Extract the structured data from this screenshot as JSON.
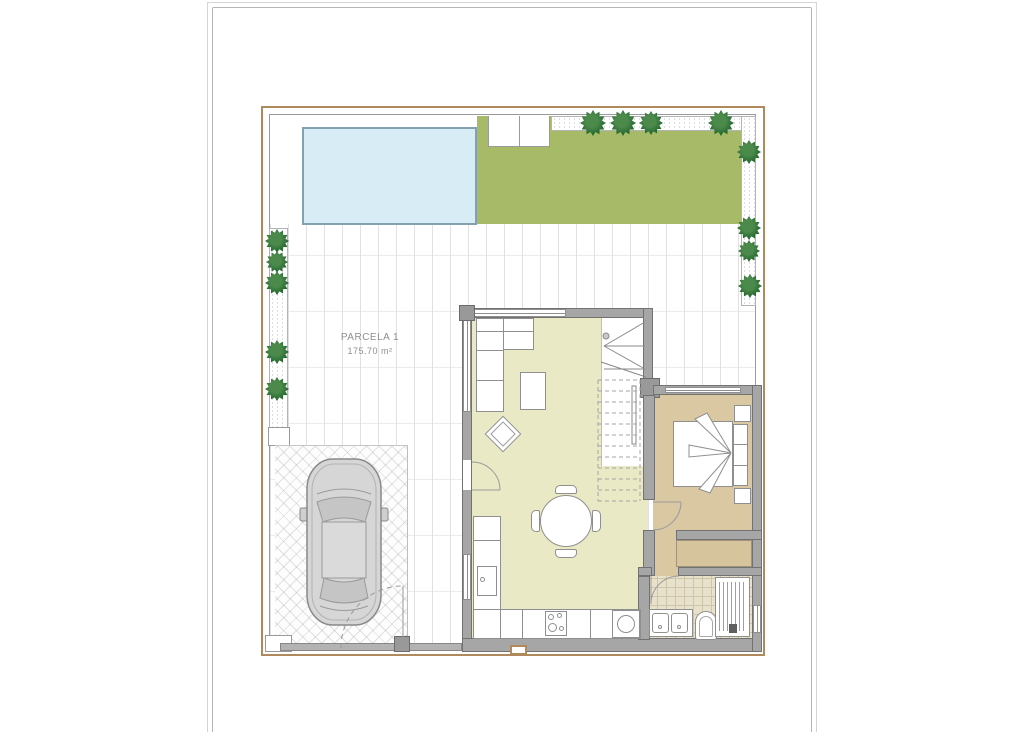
{
  "parcel": {
    "name": "PARCELA 1",
    "area": "175.70 m²"
  },
  "colors": {
    "grass": "#a7ba67",
    "pool": "#d8ecf6",
    "pool_edge": "#84a1b0",
    "floor_living": "#eae9c5",
    "floor_bedroom": "#d9c8a2",
    "floor_closet": "#d5c49c",
    "tile": "#e8e1cb",
    "tile_line": "#cfc5a9",
    "wall": "#a6a6a6",
    "wall_edge": "#727272",
    "boundary": "#b08a5c",
    "fence": "#9a9a9a",
    "tree": "#2b6d33",
    "furniture_line": "#8f8f8f",
    "grid_line": "#e1e1e1",
    "car_body": "#d6d6d6"
  },
  "trees": [
    {
      "x": 593,
      "y": 123,
      "s": 26
    },
    {
      "x": 623,
      "y": 123,
      "s": 26
    },
    {
      "x": 651,
      "y": 123,
      "s": 24
    },
    {
      "x": 721,
      "y": 123,
      "s": 26
    },
    {
      "x": 749,
      "y": 152,
      "s": 24
    },
    {
      "x": 749,
      "y": 228,
      "s": 24
    },
    {
      "x": 749,
      "y": 251,
      "s": 22
    },
    {
      "x": 750,
      "y": 286,
      "s": 24
    },
    {
      "x": 277,
      "y": 241,
      "s": 24
    },
    {
      "x": 277,
      "y": 262,
      "s": 22
    },
    {
      "x": 277,
      "y": 283,
      "s": 24
    },
    {
      "x": 277,
      "y": 352,
      "s": 24
    },
    {
      "x": 277,
      "y": 389,
      "s": 24
    }
  ]
}
